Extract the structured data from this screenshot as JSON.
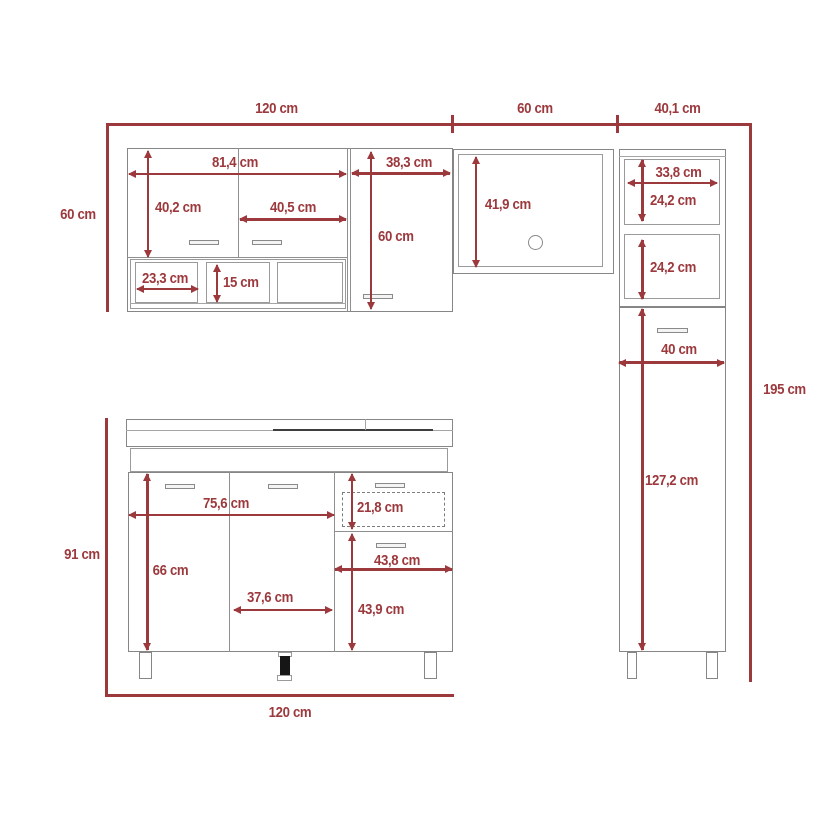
{
  "title": "kitchen-cabinet-set-dimension-diagram",
  "unit": "cm",
  "colors": {
    "dimension_red": "#9c393d",
    "outline_gray": "#868686",
    "counter_dark": "#3e3e3e",
    "foot_black": "#161616",
    "background": "#ffffff"
  },
  "dims": {
    "overall": {
      "wall_group_width": "120 cm",
      "microwave_width": "60 cm",
      "tall_width": "40,1 cm",
      "wall_height": "60 cm",
      "total_height": "195 cm",
      "base_height": "91 cm",
      "base_width": "120 cm"
    },
    "wall_cabinet": {
      "doors_span_width": "81,4 cm",
      "left_door_height": "40,2 cm",
      "right_door_width": "40,5 cm",
      "shelf_compartment_width": "23,3 cm",
      "shelf_height": "15 cm",
      "tall_door_width": "38,3 cm",
      "tall_door_height": "60 cm"
    },
    "microwave_shelf": {
      "interior_height": "41,9 cm"
    },
    "tall_cabinet": {
      "cubby_width": "33,8 cm",
      "upper_cubby_height": "24,2 cm",
      "lower_cubby_height": "24,2 cm",
      "body_width": "40 cm",
      "door_height": "127,2 cm"
    },
    "base_cabinet": {
      "doors_span_width": "75,6 cm",
      "drawer_height": "21,8 cm",
      "door_height": "66 cm",
      "middle_door_width": "37,6 cm",
      "right_section_width": "43,8 cm",
      "right_section_height": "43,9 cm"
    }
  }
}
